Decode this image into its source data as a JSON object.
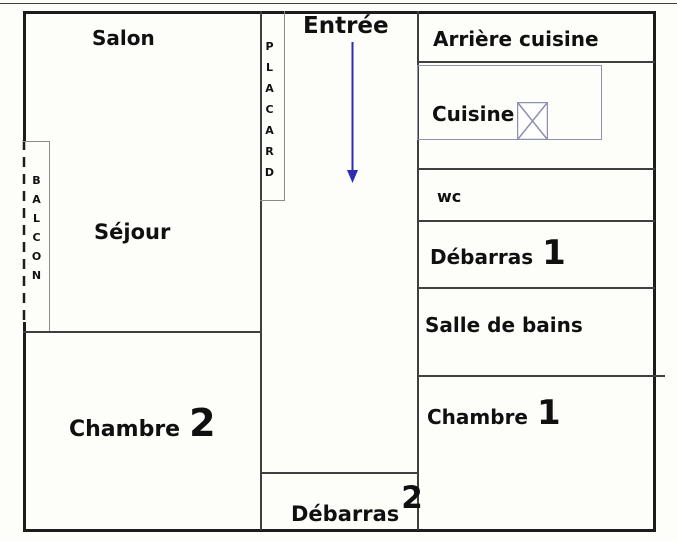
{
  "floorplan": {
    "rooms": {
      "salon": {
        "label": "Salon"
      },
      "sejour": {
        "label": "Séjour"
      },
      "chambre2": {
        "label": "Chambre",
        "number": "2"
      },
      "balcon": {
        "label": "BALCON"
      },
      "placard": {
        "label": "PLACARD"
      },
      "entree": {
        "label": "Entrée"
      },
      "debarras2": {
        "label": "Débarras",
        "number": "2"
      },
      "arriere_cuisine": {
        "label": "Arrière cuisine"
      },
      "cuisine": {
        "label": "Cuisine"
      },
      "wc": {
        "label": "wc"
      },
      "debarras1": {
        "label": "Débarras",
        "number": "1"
      },
      "salle_de_bains": {
        "label": "Salle de bains"
      },
      "chambre1": {
        "label": "Chambre",
        "number": "1"
      }
    },
    "symbols": {
      "entry_arrow": "down-arrow",
      "kitchen_window": "window-x-symbol",
      "balcony_edge": "dashed-open-edge"
    },
    "colors": {
      "wall": "#1c1c1c",
      "partition": "#3f3f3f",
      "light_partition": "#8a8a8a",
      "fixture": "#8f8fae",
      "arrow": "#2d2db4",
      "text": "#101010",
      "background": "#fdfdfa"
    }
  }
}
